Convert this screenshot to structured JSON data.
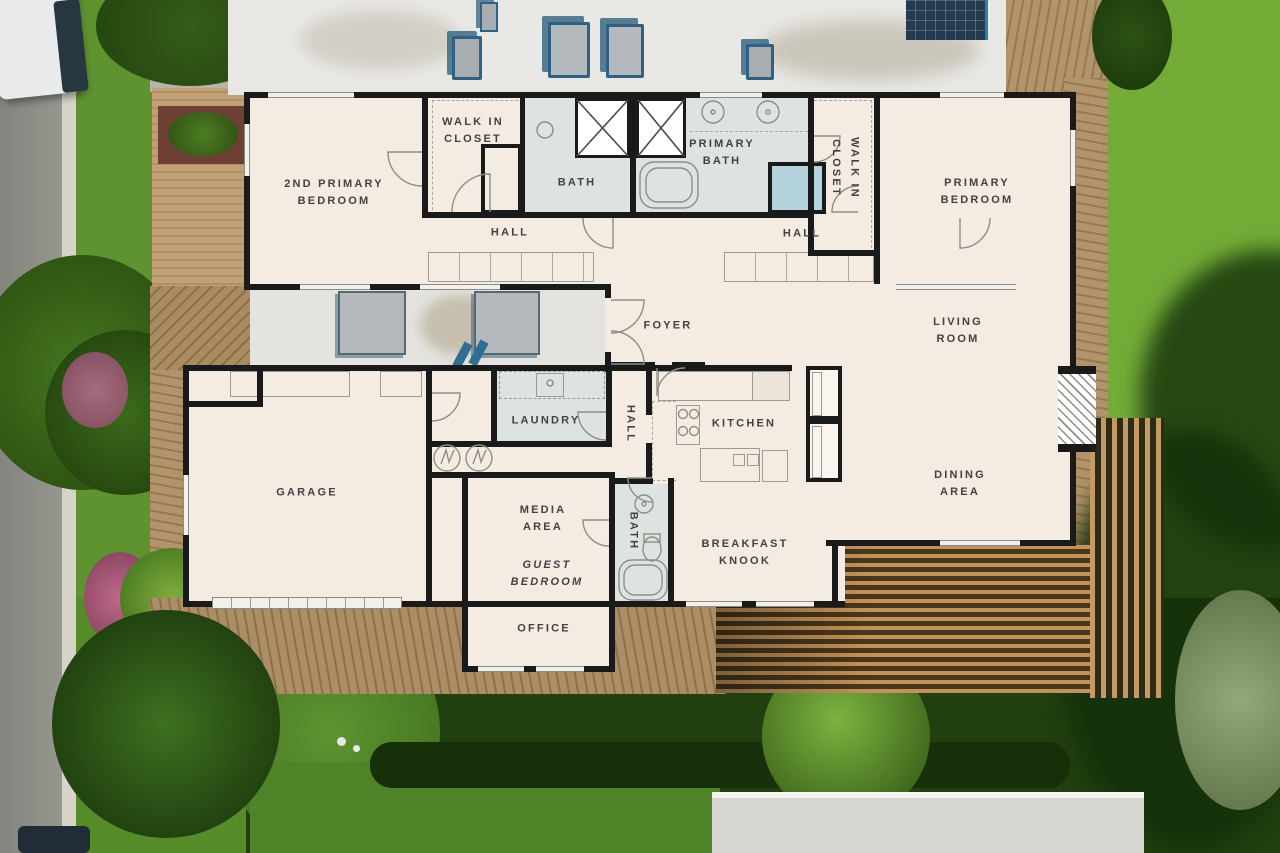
{
  "scene": {
    "type": "aerial-photo-with-floorplan-overlay",
    "view": "top-down drone view of single-story home with overlaid 2D floor plan"
  },
  "floorplan": {
    "rooms": {
      "second_primary_bedroom": {
        "label": "2ND PRIMARY\nBEDROOM"
      },
      "walk_in_closet_1": {
        "label": "WALK IN\nCLOSET"
      },
      "bath_1": {
        "label": "BATH"
      },
      "primary_bath": {
        "label": "PRIMARY\nBATH"
      },
      "walk_in_closet_2": {
        "label": "WALK IN\nCLOSET",
        "orientation": "vertical"
      },
      "primary_bedroom": {
        "label": "PRIMARY\nBEDROOM"
      },
      "hall_upper_left": {
        "label": "HALL"
      },
      "hall_upper_right": {
        "label": "HALL"
      },
      "foyer": {
        "label": "FOYER"
      },
      "living_room": {
        "label": "LIVING\nROOM"
      },
      "dining_area": {
        "label": "DINING\nAREA"
      },
      "kitchen": {
        "label": "KITCHEN"
      },
      "hall_lower": {
        "label": "HALL",
        "orientation": "vertical"
      },
      "laundry": {
        "label": "LAUNDRY"
      },
      "garage": {
        "label": "GARAGE"
      },
      "media_area": {
        "label": "MEDIA\nAREA"
      },
      "guest_bedroom": {
        "label": "GUEST\nBEDROOM",
        "style": "italic"
      },
      "office": {
        "label": "OFFICE"
      },
      "bath_2": {
        "label": "BATH",
        "orientation": "vertical"
      },
      "breakfast_knook": {
        "label": "BREAKFAST\nKNOOK"
      }
    },
    "fixtures": [
      "shower-icon",
      "double-sink-icon",
      "bathtub-icon",
      "toilet-icon",
      "washer-icon",
      "dryer-icon",
      "stove-icon",
      "kitchen-island-icon",
      "fireplace-icon",
      "wardrobe-icon"
    ],
    "colors": {
      "wall": "#1a1a1a",
      "room_fill": "#f4ebe3",
      "wet_room_fill": "#dce3e0",
      "closet_blue": "#b5d3dc",
      "label_text": "#424242",
      "fixture_line": "#8e8e86"
    }
  },
  "environment": {
    "features": [
      "street",
      "curb",
      "parked-van",
      "trees",
      "flower-beds",
      "brick-courtyard",
      "white-flat-roof",
      "skylights",
      "solar-panel",
      "shingle-roof",
      "lawn",
      "wood-deck",
      "pergola",
      "hedge",
      "neighbor-roof"
    ],
    "colors": {
      "grass": "#6aa233",
      "grass_shadow": "#1d3a0e",
      "street": "#8f8f89",
      "curb": "#d6d4c9",
      "flat_roof": "#e9e8e5",
      "skylight_frame": "#2e6183",
      "solar_panel": "#141f2b",
      "shingle": "#ab8e66",
      "deck_wood": "#c1925b",
      "brick": "#c2a075"
    }
  }
}
